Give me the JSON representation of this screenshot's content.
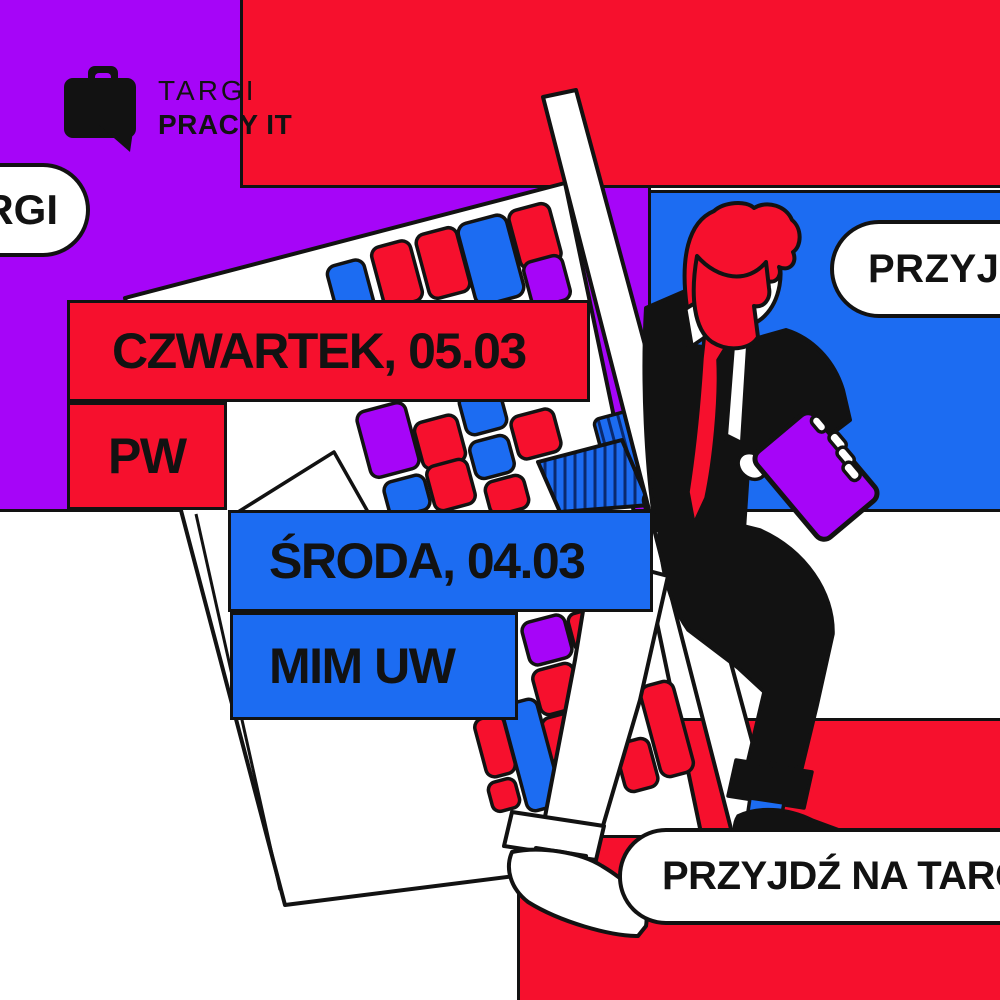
{
  "colors": {
    "red": "#F6102D",
    "blue": "#1C6CF2",
    "purple": "#A605F8",
    "ink": "#121212"
  },
  "logo": {
    "icon": "briefcase-speech-bubble-icon",
    "line1": "TARGI",
    "line2": "PRACY IT"
  },
  "speech_bubbles": {
    "left_partial": "RGI",
    "right_partial": "PRZYJD",
    "bottom_partial": "PRZYJDŹ NA TARG"
  },
  "events": [
    {
      "date_label": "CZWARTEK, 05.03",
      "venue_label": "PW",
      "theme": "red"
    },
    {
      "date_label": "ŚRODA, 04.03",
      "venue_label": "MIM UW",
      "theme": "blue"
    }
  ],
  "scene": {
    "figure": "man-in-suit-climbing-ladder",
    "objects": [
      "tilted-keyboard",
      "ladder-beam",
      "purple-tablet"
    ]
  }
}
